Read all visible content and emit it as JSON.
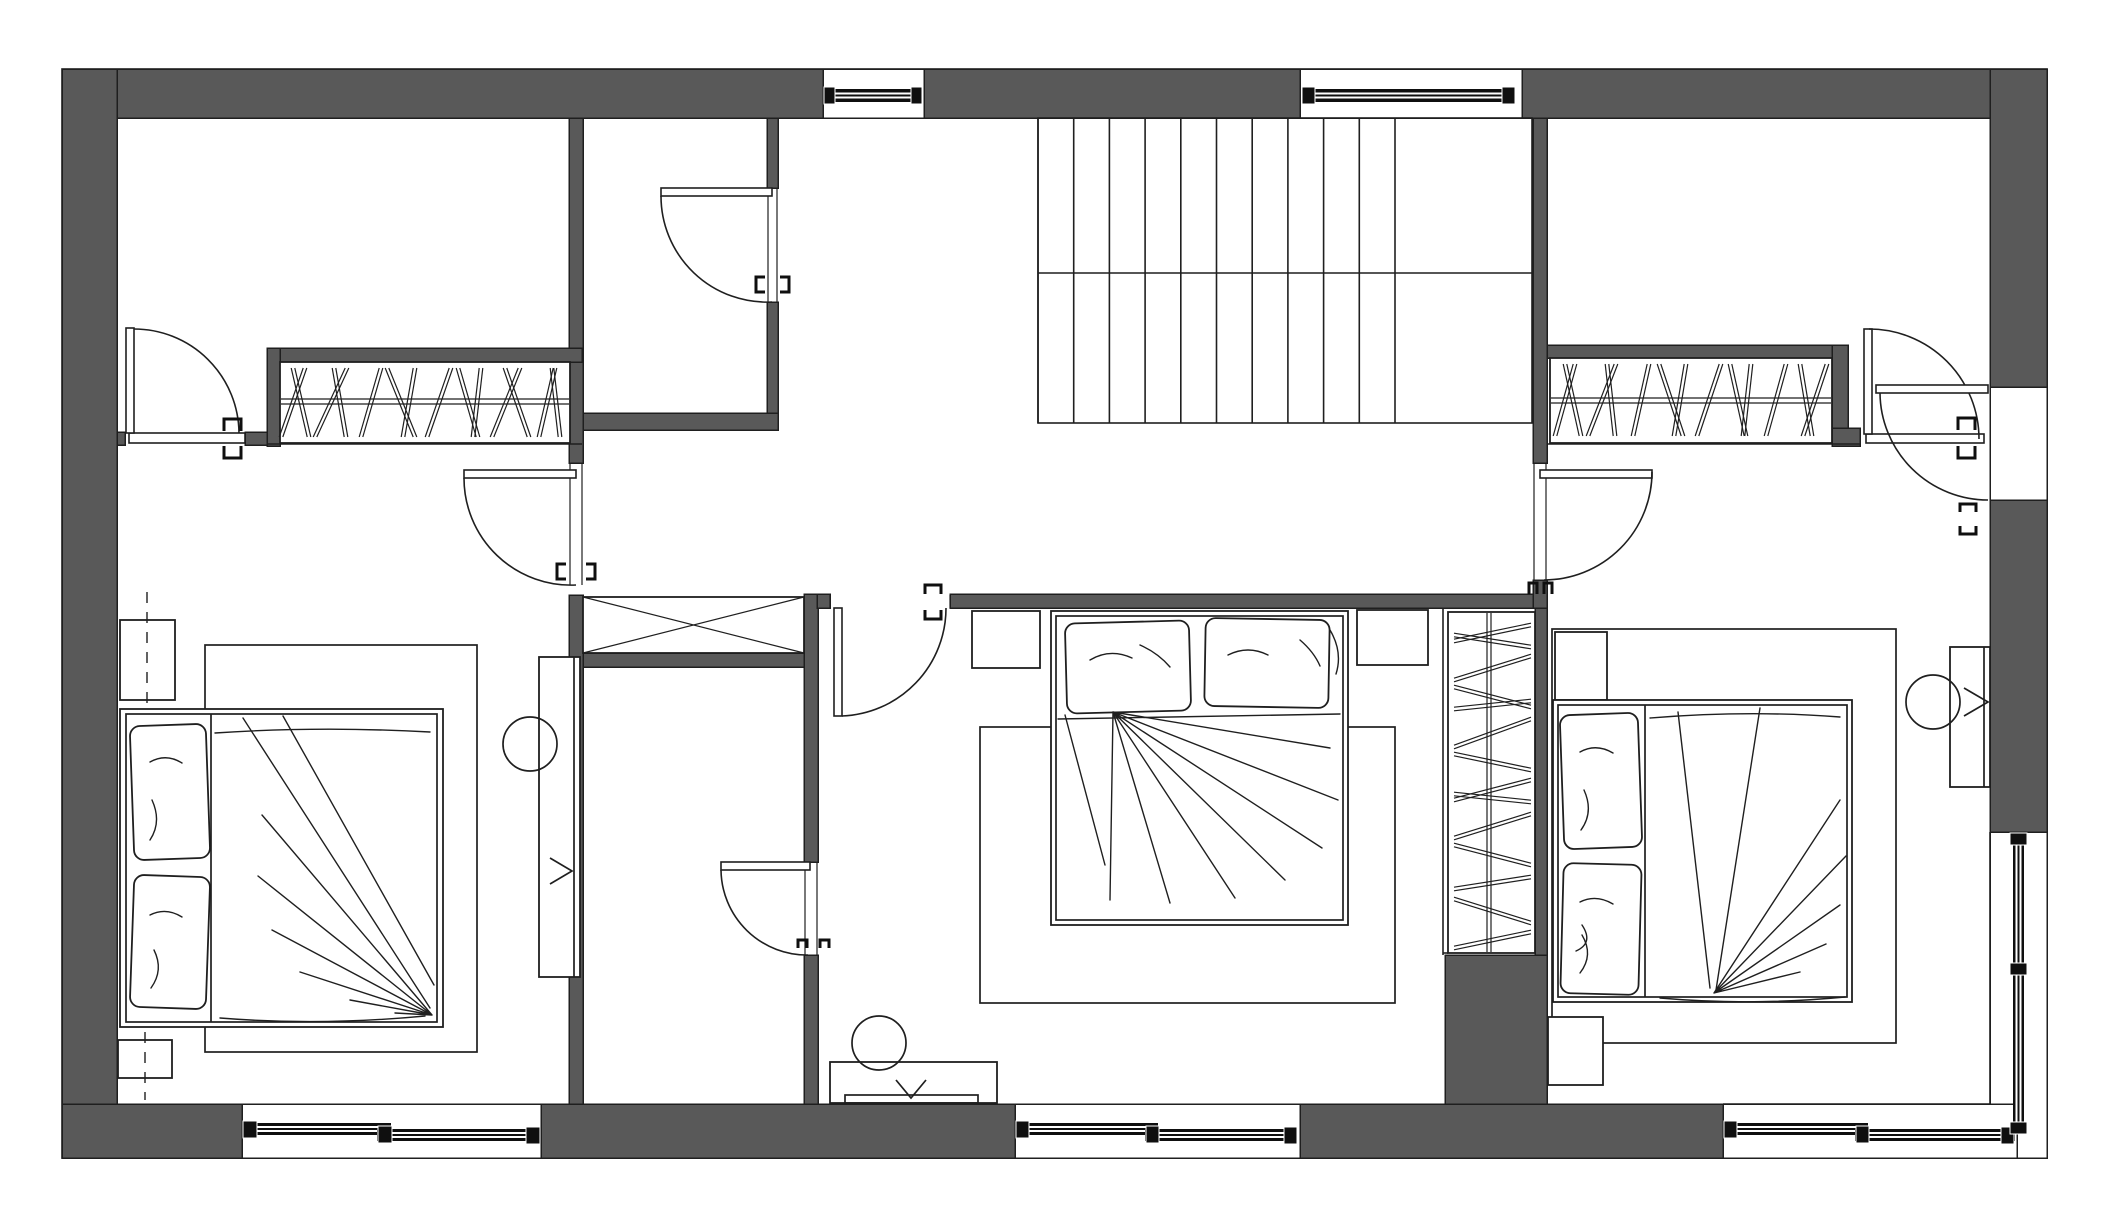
{
  "meta": {
    "document_type": "architectural floor plan",
    "view": "upper floor bedroom level, top-down",
    "visible_text": [],
    "style": "CAD line drawing, dark grey poche walls on white"
  },
  "colors": {
    "background": "#ffffff",
    "wall_fill": "#595959",
    "line": "#1f1f1f",
    "window_frame": "#0f0f0f"
  },
  "canvas": {
    "width": 2108,
    "height": 1219
  },
  "rooms": [
    {
      "name": "walk-in-closet-room-top-left",
      "bounds": [
        117,
        118,
        453,
        328
      ]
    },
    {
      "name": "wc-top",
      "bounds": [
        583,
        118,
        184,
        295
      ]
    },
    {
      "name": "stair-hall",
      "bounds": [
        778,
        118,
        755,
        477
      ]
    },
    {
      "name": "bedroom-left",
      "bounds": [
        117,
        446,
        452,
        658
      ]
    },
    {
      "name": "wc-lower",
      "bounds": [
        583,
        667,
        221,
        437
      ]
    },
    {
      "name": "bedroom-middle",
      "bounds": [
        818,
        608,
        625,
        496
      ]
    },
    {
      "name": "bedroom-right",
      "bounds": [
        1547,
        446,
        443,
        658
      ]
    }
  ],
  "inventory": {
    "beds": 3,
    "closets_with_hangers": 3,
    "doors": 8,
    "windows": 6,
    "stair_flights": 2,
    "desks": 3,
    "stools": 3,
    "nightstands": 6,
    "rugs": 3,
    "service_shaft_with_x": 1
  },
  "plan": {
    "walls": [
      {
        "name": "top-wall-a",
        "r": [
          62,
          69,
          761,
          49
        ]
      },
      {
        "name": "top-wall-b",
        "r": [
          924,
          69,
          376,
          49
        ]
      },
      {
        "name": "top-wall-c",
        "r": [
          1522,
          69,
          525,
          49
        ]
      },
      {
        "name": "left-wall",
        "r": [
          62,
          69,
          55,
          1089
        ]
      },
      {
        "name": "right-wall-a",
        "r": [
          1990,
          69,
          57,
          318
        ]
      },
      {
        "name": "right-wall-b",
        "r": [
          1990,
          500,
          57,
          332
        ]
      },
      {
        "name": "bottom-wall-a",
        "r": [
          62,
          1104,
          180,
          54
        ]
      },
      {
        "name": "bottom-wall-b",
        "r": [
          541,
          1104,
          474,
          54
        ]
      },
      {
        "name": "bottom-wall-c",
        "r": [
          1300,
          1104,
          423,
          54
        ]
      },
      {
        "name": "wardrobe-column",
        "r": [
          1445,
          955,
          102,
          149
        ]
      },
      {
        "name": "hall-west-wall-upper",
        "r": [
          569,
          118,
          14,
          345
        ]
      },
      {
        "name": "hall-west-wall-lower",
        "r": [
          569,
          595,
          14,
          509
        ]
      },
      {
        "name": "wc-top-east-wall-a",
        "r": [
          767,
          118,
          11,
          70
        ]
      },
      {
        "name": "wc-top-east-wall-b",
        "r": [
          767,
          302,
          11,
          128
        ]
      },
      {
        "name": "wc-top-south-wall",
        "r": [
          583,
          413,
          195,
          17
        ]
      },
      {
        "name": "wc-low-east-wall-a",
        "r": [
          804,
          594,
          14,
          268
        ]
      },
      {
        "name": "wc-low-east-wall-b",
        "r": [
          804,
          955,
          14,
          149
        ]
      },
      {
        "name": "shaft-south-wall",
        "r": [
          583,
          653,
          221,
          14
        ]
      },
      {
        "name": "mb-north-wall-stub",
        "r": [
          817,
          594,
          13,
          14
        ]
      },
      {
        "name": "mb-north-wall-main",
        "r": [
          950,
          594,
          583,
          14
        ]
      },
      {
        "name": "hall-east-wall-upper",
        "r": [
          1533,
          118,
          14,
          345
        ]
      },
      {
        "name": "hall-east-wall-stub",
        "r": [
          1533,
          580,
          14,
          28
        ]
      },
      {
        "name": "wardrobe-east-wall",
        "r": [
          1535,
          608,
          12,
          347
        ]
      },
      {
        "name": "closet-left-top",
        "r": [
          267,
          348,
          315,
          14
        ]
      },
      {
        "name": "closet-left-west",
        "r": [
          267,
          348,
          13,
          98
        ]
      },
      {
        "name": "closet-right-top",
        "r": [
          1547,
          345,
          301,
          13
        ]
      },
      {
        "name": "closet-right-east",
        "r": [
          1832,
          345,
          16,
          83
        ]
      },
      {
        "name": "closet-right-step",
        "r": [
          1832,
          428,
          28,
          18
        ]
      },
      {
        "name": "tl-room-south-wall-a",
        "r": [
          117,
          432,
          8,
          13
        ]
      },
      {
        "name": "tl-room-south-wall-b",
        "r": [
          245,
          432,
          22,
          13
        ]
      }
    ],
    "outer_outline": [
      62,
      69,
      1985,
      1089
    ],
    "window_recesses": [
      {
        "name": "window-top-1",
        "r": [
          823,
          69,
          101,
          49
        ]
      },
      {
        "name": "window-top-2",
        "r": [
          1300,
          69,
          222,
          49
        ]
      },
      {
        "name": "entry-recess-right",
        "r": [
          1990,
          387,
          57,
          113
        ]
      },
      {
        "name": "window-right",
        "r": [
          1990,
          832,
          57,
          326
        ]
      },
      {
        "name": "window-bottom-left",
        "r": [
          242,
          1104,
          299,
          54
        ]
      },
      {
        "name": "window-bottom-middle",
        "r": [
          1015,
          1104,
          285,
          54
        ]
      },
      {
        "name": "window-bottom-right",
        "r": [
          1723,
          1104,
          294,
          54
        ]
      }
    ],
    "window_bars": [
      [
        827,
        89,
        90,
        13
      ],
      [
        1304,
        89,
        211,
        13
      ],
      [
        245,
        1123,
        146,
        12
      ],
      [
        377,
        1129,
        160,
        12
      ],
      [
        1018,
        1123,
        140,
        12
      ],
      [
        1145,
        1129,
        152,
        12
      ],
      [
        1726,
        1123,
        142,
        12
      ],
      [
        1855,
        1129,
        160,
        12
      ],
      [
        2013,
        835,
        11,
        140
      ],
      [
        2013,
        970,
        11,
        158
      ]
    ],
    "window_caps": [
      [
        824,
        87,
        11,
        17
      ],
      [
        911,
        87,
        11,
        17
      ],
      [
        1302,
        87,
        13,
        17
      ],
      [
        1502,
        87,
        13,
        17
      ],
      [
        243,
        1121,
        14,
        17
      ],
      [
        378,
        1126,
        14,
        17
      ],
      [
        526,
        1127,
        14,
        17
      ],
      [
        1016,
        1121,
        13,
        17
      ],
      [
        1146,
        1126,
        13,
        17
      ],
      [
        1284,
        1127,
        13,
        17
      ],
      [
        1724,
        1121,
        13,
        17
      ],
      [
        1856,
        1126,
        13,
        17
      ],
      [
        2001,
        1127,
        13,
        17
      ],
      [
        2010,
        833,
        17,
        12
      ],
      [
        2010,
        963,
        17,
        12
      ],
      [
        2010,
        1122,
        17,
        12
      ]
    ],
    "thin_lines": [
      [
        267,
        444,
        582,
        444
      ],
      [
        1547,
        444,
        1860,
        444
      ],
      [
        1723,
        1104,
        1990,
        1104
      ],
      [
        1990,
        832,
        1990,
        1104
      ],
      [
        1443,
        608,
        1443,
        955
      ],
      [
        1443,
        953,
        1448,
        953
      ]
    ],
    "stairs": {
      "x0": 1038,
      "x1": 1395,
      "x2": 1532,
      "yTop": 118,
      "yBot": 423,
      "yMid": 273,
      "treads": 10
    },
    "shaft": {
      "box": [
        583,
        597,
        221,
        56
      ]
    },
    "closet_interiors": [
      {
        "name": "closet-left-interior",
        "r": [
          280,
          362,
          290,
          81
        ]
      },
      {
        "name": "closet-right-interior",
        "r": [
          1550,
          358,
          282,
          85
        ]
      },
      {
        "name": "wardrobe-interior",
        "r": [
          1448,
          612,
          87,
          341
        ]
      }
    ],
    "closets": [
      {
        "name": "closet-left",
        "type": "h",
        "rail": [
          281,
          399,
          569,
          404
        ],
        "y1": 368,
        "y2": 437,
        "hangers": [
          [
            293,
            6
          ],
          [
            301,
            -4
          ],
          [
            331,
            8
          ],
          [
            340,
            -3
          ],
          [
            371,
            5
          ],
          [
            401,
            -7
          ],
          [
            409,
            3
          ],
          [
            439,
            6
          ],
          [
            468,
            -5
          ],
          [
            477,
            2
          ],
          [
            506,
            7
          ],
          [
            517,
            -6
          ],
          [
            547,
            4
          ],
          [
            556,
            -2
          ]
        ]
      },
      {
        "name": "closet-right",
        "type": "h",
        "rail": [
          1551,
          398,
          1831,
          403
        ],
        "y1": 364,
        "y2": 436,
        "hangers": [
          [
            1565,
            5
          ],
          [
            1573,
            -4
          ],
          [
            1602,
            7
          ],
          [
            1611,
            -2
          ],
          [
            1641,
            4
          ],
          [
            1671,
            -6
          ],
          [
            1680,
            3
          ],
          [
            1709,
            6
          ],
          [
            1738,
            -4
          ],
          [
            1747,
            2
          ],
          [
            1776,
            5
          ],
          [
            1806,
            -3
          ],
          [
            1815,
            6
          ]
        ]
      },
      {
        "name": "wardrobe",
        "type": "v",
        "rail": [
          1487,
          613,
          1491,
          952
        ],
        "x1": 1454,
        "x2": 1531,
        "hangers": [
          [
            633,
            4
          ],
          [
            641,
            -3
          ],
          [
            668,
            6
          ],
          [
            697,
            -5
          ],
          [
            705,
            2
          ],
          [
            733,
            7
          ],
          [
            762,
            -4
          ],
          [
            790,
            5
          ],
          [
            798,
            -2
          ],
          [
            826,
            6
          ],
          [
            855,
            -5
          ],
          [
            883,
            3
          ],
          [
            911,
            -6
          ],
          [
            940,
            4
          ]
        ]
      }
    ],
    "doors": [
      {
        "name": "door-top-left-room",
        "wall": "tl-room-south",
        "opening": [
          125,
          432,
          120,
          13
        ],
        "swing": "up-into-room"
      },
      {
        "name": "door-wc-top",
        "wall": "wc-top-east",
        "opening": [
          767,
          188,
          11,
          114
        ],
        "swing": "west-into-wc"
      },
      {
        "name": "door-bedroom-left",
        "wall": "hall-west",
        "opening": [
          569,
          463,
          14,
          122
        ],
        "swing": "west-into-bedroom"
      },
      {
        "name": "door-bedroom-middle",
        "wall": "mb-north",
        "opening": [
          830,
          594,
          120,
          14
        ],
        "swing": "south-into-bedroom"
      },
      {
        "name": "door-wc-lower",
        "wall": "wc-low-east",
        "opening": [
          804,
          862,
          14,
          93
        ],
        "swing": "west-into-wc"
      },
      {
        "name": "door-right-room-closet-side",
        "opening": [
          1860,
          432,
          130,
          13
        ],
        "swing": "up-into-room"
      },
      {
        "name": "door-bedroom-right",
        "wall": "hall-east",
        "opening": [
          1533,
          463,
          14,
          117
        ],
        "swing": "east-into-bedroom"
      },
      {
        "name": "door-right-wall",
        "wall": "right-outer",
        "opening": [
          1990,
          387,
          57,
          113
        ],
        "swing": "west-into-room"
      }
    ],
    "furniture": {
      "bedroom-left": {
        "bed": [
          120,
          709,
          323,
          318
        ],
        "pillows": 2,
        "rug": [
          205,
          645,
          272,
          407
        ],
        "desk": [
          539,
          657,
          41,
          320
        ],
        "stool": [
          530,
          744,
          27
        ],
        "nightstands": [
          [
            120,
            620,
            55,
            80
          ],
          [
            118,
            1040,
            54,
            38
          ]
        ]
      },
      "bedroom-middle": {
        "bed": [
          1051,
          611,
          297,
          314
        ],
        "pillows": 2,
        "rug": [
          980,
          727,
          415,
          276
        ],
        "vanity": [
          830,
          1062,
          167,
          41
        ],
        "stool": [
          879,
          1043,
          27
        ],
        "nightstands": [
          [
            972,
            611,
            68,
            57
          ],
          [
            1357,
            610,
            71,
            55
          ]
        ]
      },
      "bedroom-right": {
        "bed": [
          1553,
          700,
          299,
          302
        ],
        "pillows": 2,
        "rug": [
          1552,
          629,
          344,
          414
        ],
        "desk": [
          1950,
          647,
          40,
          140
        ],
        "stool": [
          1933,
          702,
          27
        ],
        "nightstands": [
          [
            1555,
            632,
            52,
            68
          ],
          [
            1548,
            1017,
            55,
            68
          ]
        ]
      }
    }
  }
}
